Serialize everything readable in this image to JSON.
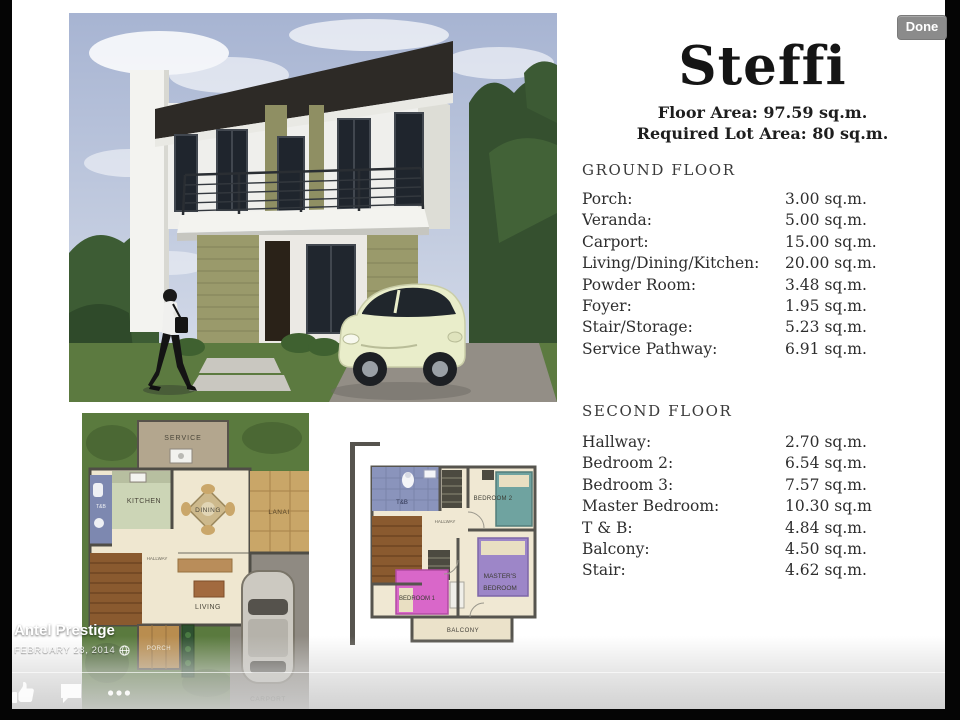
{
  "chrome": {
    "done_label": "Done",
    "author": "Antel Prestige",
    "date": "FEBRUARY 28, 2014"
  },
  "flyer": {
    "title": "Steffi",
    "floor_area_line": "Floor Area: 97.59 sq.m.",
    "lot_area_line": "Required Lot Area: 80 sq.m.",
    "ground_floor": {
      "heading": "GROUND FLOOR",
      "items": [
        {
          "label": "Porch:",
          "value": "3.00 sq.m."
        },
        {
          "label": "Veranda:",
          "value": "5.00 sq.m."
        },
        {
          "label": "Carport:",
          "value": "15.00 sq.m."
        },
        {
          "label": "Living/Dining/Kitchen:",
          "value": "20.00 sq.m."
        },
        {
          "label": "Powder Room:",
          "value": "3.48 sq.m."
        },
        {
          "label": "Foyer:",
          "value": "1.95 sq.m."
        },
        {
          "label": "Stair/Storage:",
          "value": "5.23 sq.m."
        },
        {
          "label": "Service Pathway:",
          "value": "6.91 sq.m."
        }
      ]
    },
    "second_floor": {
      "heading": "SECOND FLOOR",
      "items": [
        {
          "label": "Hallway:",
          "value": "2.70 sq.m."
        },
        {
          "label": "Bedroom 2:",
          "value": "6.54 sq.m."
        },
        {
          "label": "Bedroom 3:",
          "value": "7.57 sq.m."
        },
        {
          "label": "Master Bedroom:",
          "value": "10.30 sq.m"
        },
        {
          "label": "T & B:",
          "value": "4.84 sq.m."
        },
        {
          "label": "Balcony:",
          "value": "4.50 sq.m."
        },
        {
          "label": "Stair:",
          "value": "4.62 sq.m."
        }
      ]
    },
    "ground_plan_labels": {
      "service": "SERVICE",
      "kitchen": "KITCHEN",
      "tb": "T&B",
      "dining": "DINING",
      "lanai": "LANAI",
      "hallway": "HALLWAY",
      "living": "LIVING",
      "porch": "PORCH",
      "carport": "CARPORT"
    },
    "second_plan_labels": {
      "tb": "T&B",
      "hallway": "HALLWAY",
      "bedroom2": "BEDROOM 2",
      "masters_line1": "MASTER'S",
      "masters_line2": "BEDROOM",
      "bedroom1": "BEDROOM 1",
      "balcony": "BALCONY"
    }
  },
  "colors": {
    "done_bg": "#8b8b8b",
    "letterbox": "#050505",
    "page_bg": "#ffffff",
    "ink": "#2e2e2e"
  }
}
